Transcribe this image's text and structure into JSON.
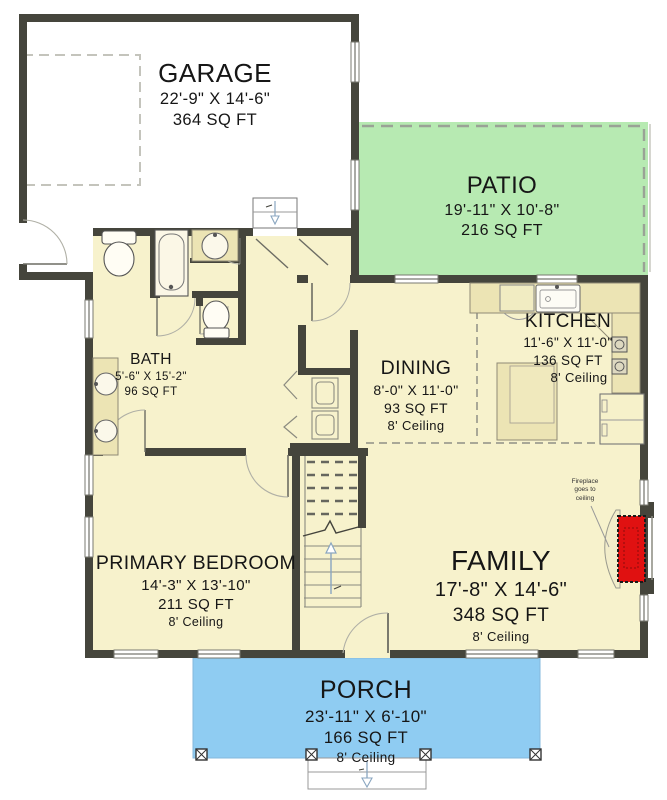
{
  "plan_title": "First Floor Plan",
  "rooms": {
    "garage": {
      "name": "GARAGE",
      "dims": "22'-9\" X 14'-6\"",
      "area": "364 SQ FT"
    },
    "patio": {
      "name": "PATIO",
      "dims": "19'-11\" X 10'-8\"",
      "area": "216 SQ FT"
    },
    "kitchen": {
      "name": "KITCHEN",
      "dims": "11'-6\" X 11'-0\"",
      "area": "136 SQ FT",
      "ceiling": "8' Ceiling"
    },
    "dining": {
      "name": "DINING",
      "dims": "8'-0\" X 11'-0\"",
      "area": "93 SQ FT",
      "ceiling": "8' Ceiling"
    },
    "bath": {
      "name": "BATH",
      "dims": "5'-6\" X 15'-2\"",
      "area": "96 SQ FT"
    },
    "primary_bedroom": {
      "name": "PRIMARY BEDROOM",
      "dims": "14'-3\" X 13'-10\"",
      "area": "211 SQ FT",
      "ceiling": "8' Ceiling"
    },
    "family": {
      "name": "FAMILY",
      "dims": "17'-8\" X 14'-6\"",
      "area": "348 SQ FT",
      "ceiling": "8' Ceiling"
    },
    "porch": {
      "name": "PORCH",
      "dims": "23'-11\" X 6'-10\"",
      "area": "166 SQ FT",
      "ceiling": "8' Ceiling"
    }
  },
  "annotations": {
    "fireplace_note": {
      "l1": "Fireplace",
      "l2": "goes to",
      "l3": "ceiling"
    }
  },
  "colors": {
    "floor": "#f7f2cc",
    "patio": "#b7eab2",
    "porch": "#8fccf2",
    "wall": "#45453c",
    "fireplace": "#e01111",
    "counter": "#ece4b4",
    "stair_arrow": "#8aa6c0"
  }
}
